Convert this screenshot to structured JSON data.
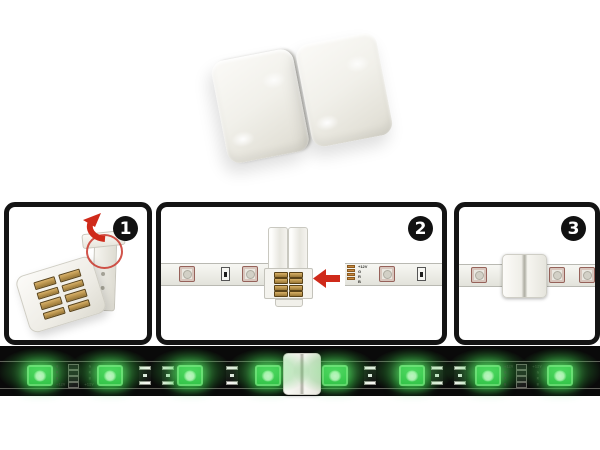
{
  "steps": [
    {
      "number": "1"
    },
    {
      "number": "2"
    },
    {
      "number": "3"
    }
  ],
  "pad_labels": [
    "+12V",
    "G",
    "R",
    "B"
  ],
  "bottom_strip": {
    "marking_labels": [
      "G",
      "R",
      "B",
      "+12V"
    ],
    "led_count": 8
  },
  "colors": {
    "led_green": "#2ec548",
    "glow_green": "#52d965",
    "arrow_red": "#cf2a1a",
    "highlight_circle_red": "#c9362c",
    "panel_border": "#141414",
    "band_black": "#0a0a0a",
    "strip_body": "#ebebe5",
    "connector_white": "#f6f5f0",
    "copper_pad": "#c9893f",
    "badge_bg": "#111111",
    "badge_text": "#ffffff"
  }
}
